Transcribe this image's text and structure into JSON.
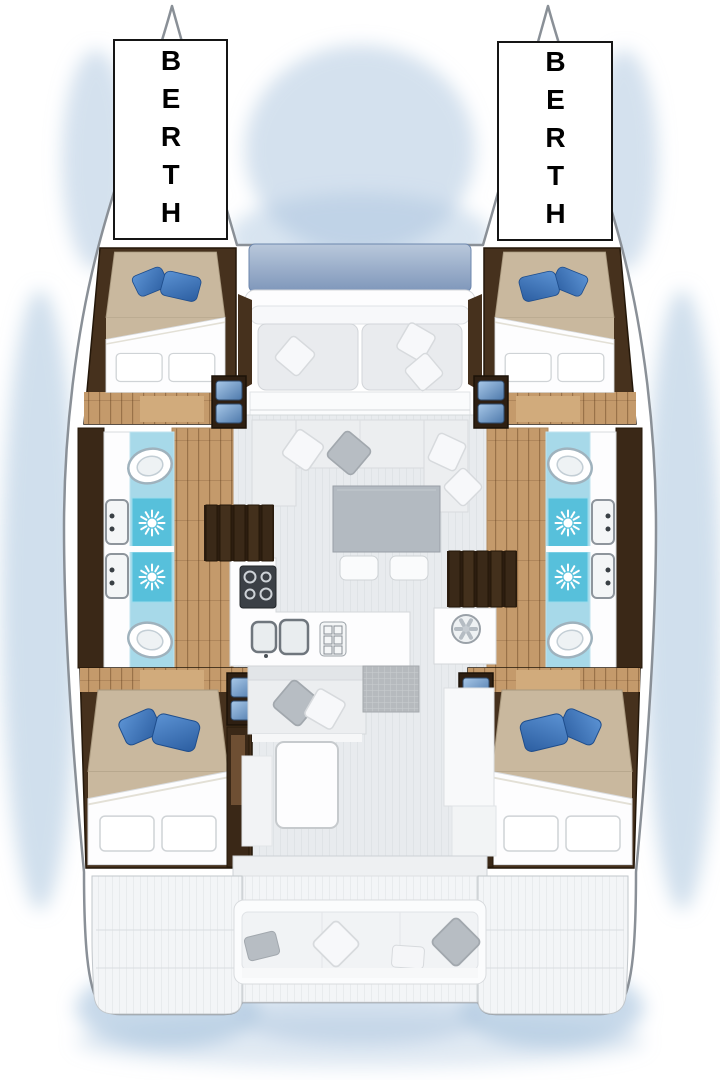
{
  "labels": {
    "port_berth": "BERTH",
    "starboard_berth": "BERTH"
  },
  "fixtures": [
    "toilet-icon",
    "shower-sun-drain-icon",
    "washbasin-icon",
    "double-sink-icon",
    "stove-burners-icon",
    "extractor-fan-icon",
    "companionway-steps-icon",
    "bed",
    "blue-pillow",
    "white-pillow",
    "trampoline",
    "cockpit-bench"
  ],
  "palette": {
    "water_shadow": "#a9c4de",
    "hull_white": "#ffffff",
    "outline_gray": "#8a9097",
    "wood_dark": "#46311d",
    "wood_mid": "#6e4f33",
    "wood_light": "#c49a6b",
    "bed_tan": "#c9b89e",
    "duvet_white": "#fdfdfe",
    "pillow_blue": "#3d7bc0",
    "bath_cyan": "#a7d9e9",
    "shower_cyan": "#57c0db",
    "deck_gray": "#e9ebee",
    "sofa_gray": "#eceef0",
    "table_gray": "#b3bac1",
    "trampoline_blue": "#8ba2c2",
    "stove_dark": "#3b4046",
    "step_blue": "#7fa9d4"
  }
}
